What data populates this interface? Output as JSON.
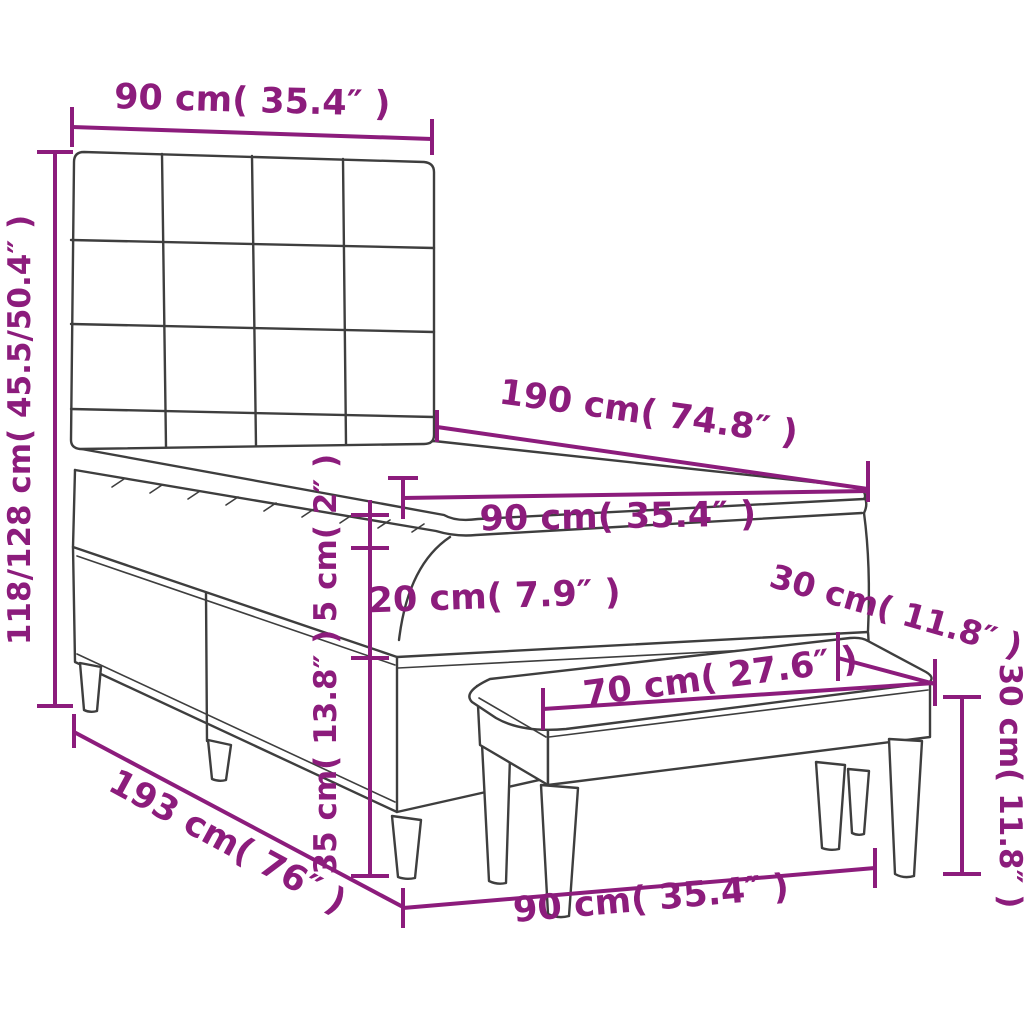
{
  "diagram": {
    "description": "Box spring bed with tufted headboard and bench, dimension drawing",
    "accent_color": "#8c1c7c",
    "line_color": "#3e3e3e",
    "dimensions": {
      "headboard_width": "90 cm( 35.4″ )",
      "bed_height_range": "118/128 cm( 45.5/50.4″ )",
      "mattress_length": "190 cm( 74.8″ )",
      "mattress_width": "90 cm( 35.4″ )",
      "topper_height": "5 cm( 2″ )",
      "mattress_height": "20 cm( 7.9″ )",
      "base_height": "35 cm( 13.8″ )",
      "base_length": "193 cm( 76″ )",
      "base_width": "90 cm( 35.4″ )",
      "bench_length": "70 cm( 27.6″ )",
      "bench_depth": "30 cm( 11.8″ )",
      "bench_height": "30 cm( 11.8″ )"
    }
  }
}
